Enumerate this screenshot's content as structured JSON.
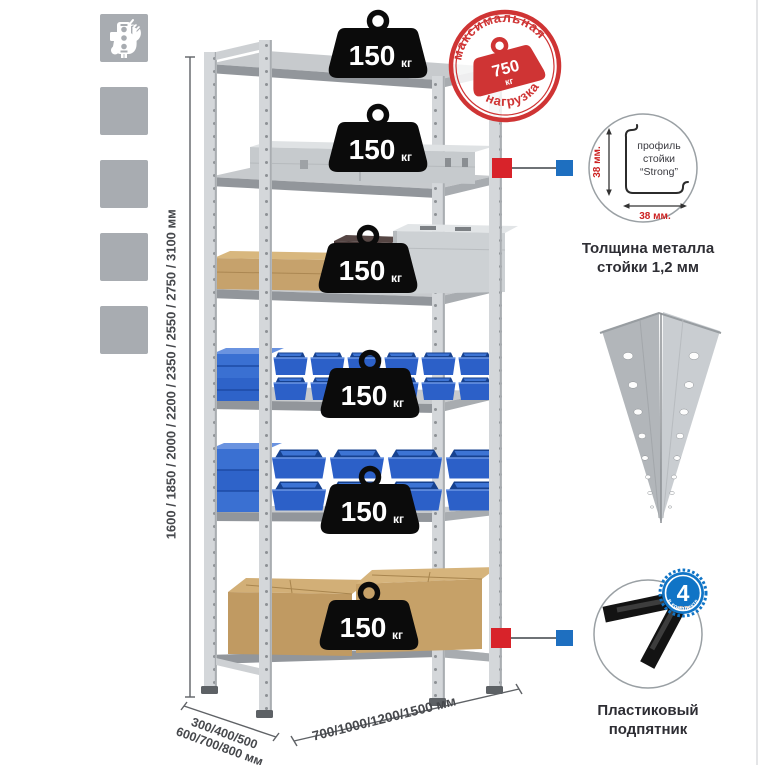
{
  "icons": [
    {
      "name": "wrench"
    },
    {
      "name": "gloves"
    },
    {
      "name": "drill"
    },
    {
      "name": "person"
    },
    {
      "name": "level"
    }
  ],
  "weights": [
    {
      "value": "150",
      "unit": "кг"
    },
    {
      "value": "150",
      "unit": "кг"
    },
    {
      "value": "150",
      "unit": "кг"
    },
    {
      "value": "150",
      "unit": "кг"
    },
    {
      "value": "150",
      "unit": "кг"
    },
    {
      "value": "150",
      "unit": "кг"
    }
  ],
  "stamp": {
    "arc_top": "максимальная",
    "arc_bottom": "нагрузка",
    "value": "750",
    "unit": "кг"
  },
  "profile_detail": {
    "line1": "профиль",
    "line2": "стойки",
    "line3": "“Strong”",
    "dim_vertical": "38 мм.",
    "dim_horizontal": "38 мм.",
    "caption_line1": "Толщина металла",
    "caption_line2": "стойки 1,2 мм"
  },
  "foot_detail": {
    "badge_number": "4",
    "badge_small": "штуки",
    "badge_arc": "в комплекте",
    "caption_line1": "Пластиковый",
    "caption_line2": "подпятник"
  },
  "dimensions": {
    "height": "1600 / 1850 / 2000 / 2200 / 2350 / 2550 / 2750 / 3100 мм",
    "depth_line1": "300/400/500",
    "depth_line2": "600/700/800 мм",
    "width": "700/1000/1200/1500 мм"
  },
  "colors": {
    "stamp_red": "#cf3434",
    "callout_red": "#d8232a",
    "callout_blue": "#1e6fc0",
    "bin_blue": "#2c60c8",
    "metal_gray": "#c7cacd",
    "cardboard_tan": "#c6a26c",
    "icon_gray": "#a8acb1",
    "dimension_red": "#cc2222"
  }
}
